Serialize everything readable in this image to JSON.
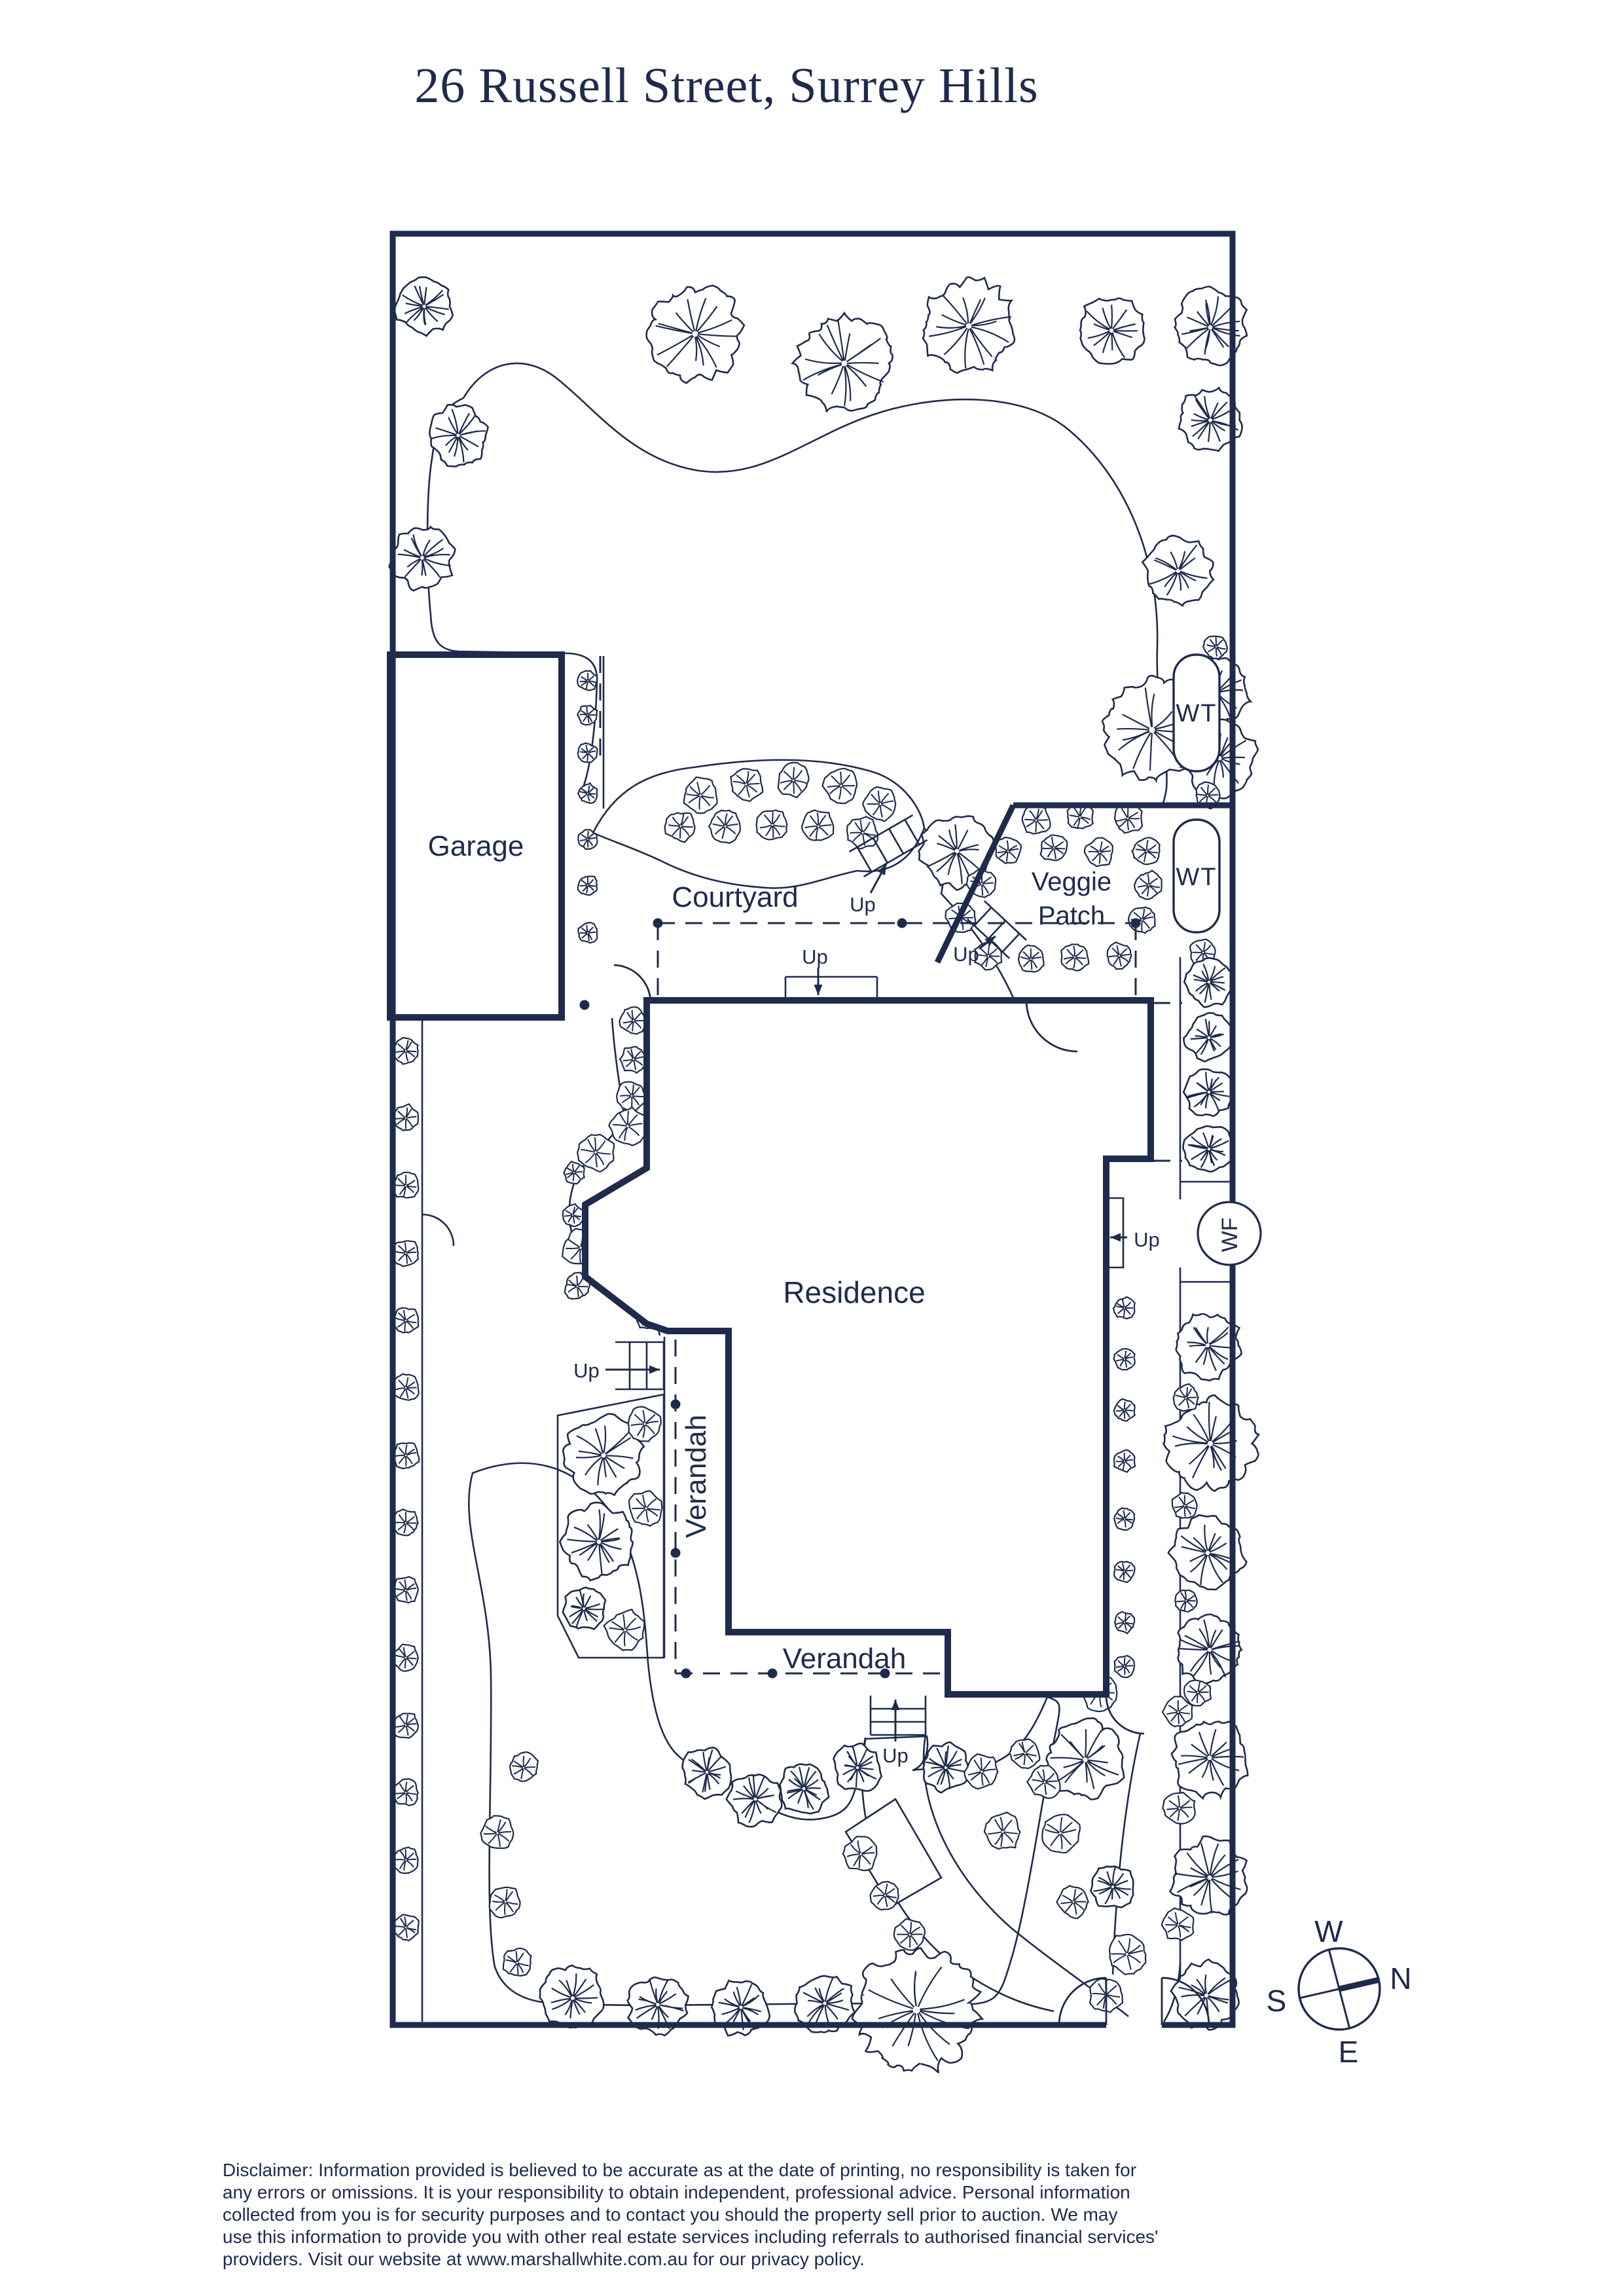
{
  "title": "26 Russell Street, Surrey Hills",
  "plan": {
    "garage": "Garage",
    "courtyard": "Courtyard",
    "veggie_patch_line1": "Veggie",
    "veggie_patch_line2": "Patch",
    "residence": "Residence",
    "verandah_west": "Verandah",
    "verandah_south": "Verandah",
    "water_tank_1": "WT",
    "water_tank_2": "WT",
    "water_feature": "WF",
    "up": "Up"
  },
  "compass": {
    "west": "W",
    "north": "N",
    "south": "S",
    "east": "E"
  },
  "disclaimer": {
    "lines": [
      "Disclaimer: Information provided is believed to be accurate as at the date of printing, no responsibility is taken for",
      "any errors or omissions. It is your responsibility to obtain independent, professional advice. Personal information",
      "collected from you is for security purposes and to contact you should the property sell prior to auction. We may",
      "use this information to provide you with other real estate services including referrals to authorised financial services'",
      "providers. Visit our website at www.marshallwhite.com.au for our privacy policy."
    ]
  },
  "colors": {
    "ink": "#1e2b4c",
    "background": "#ffffff"
  }
}
